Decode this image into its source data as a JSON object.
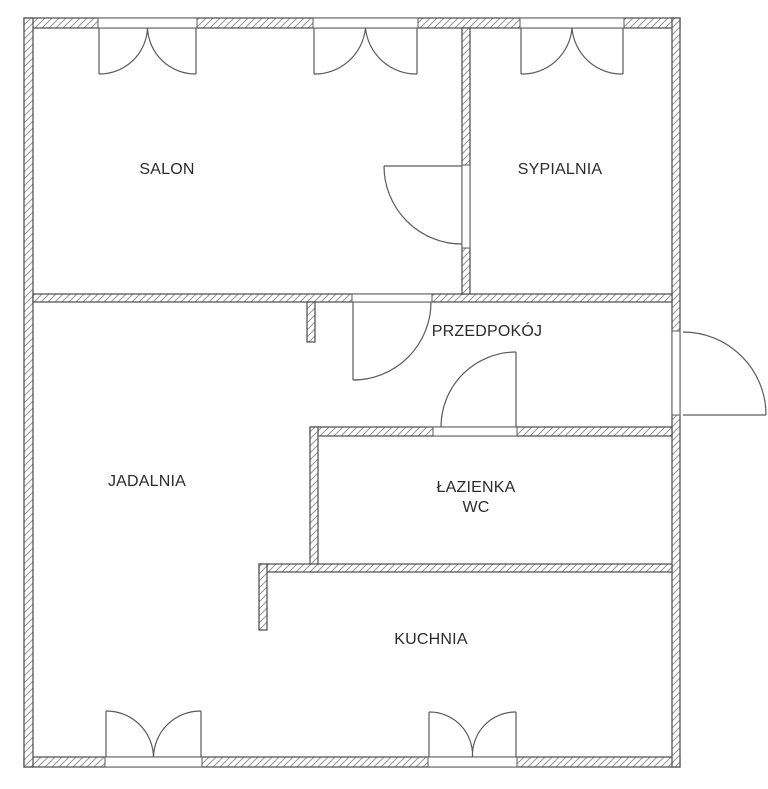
{
  "floor_plan": {
    "rooms": [
      {
        "id": "salon",
        "label": "SALON"
      },
      {
        "id": "sypialnia",
        "label": "SYPIALNIA"
      },
      {
        "id": "przedpokoj",
        "label": "PRZEDPOKÓJ"
      },
      {
        "id": "jadalnia",
        "label": "JADALNIA"
      },
      {
        "id": "lazienka-wc",
        "label": "ŁAZIENKA",
        "sublabel": "WC"
      },
      {
        "id": "kuchnia",
        "label": "KUCHNIA"
      }
    ],
    "colors": {
      "background": "#ffffff",
      "wall_outline": "#4a4a4a",
      "wall_hatch": "#9a9a9a",
      "symbol_line": "#5a5a5a",
      "label_text": "#2b2b2b"
    }
  }
}
